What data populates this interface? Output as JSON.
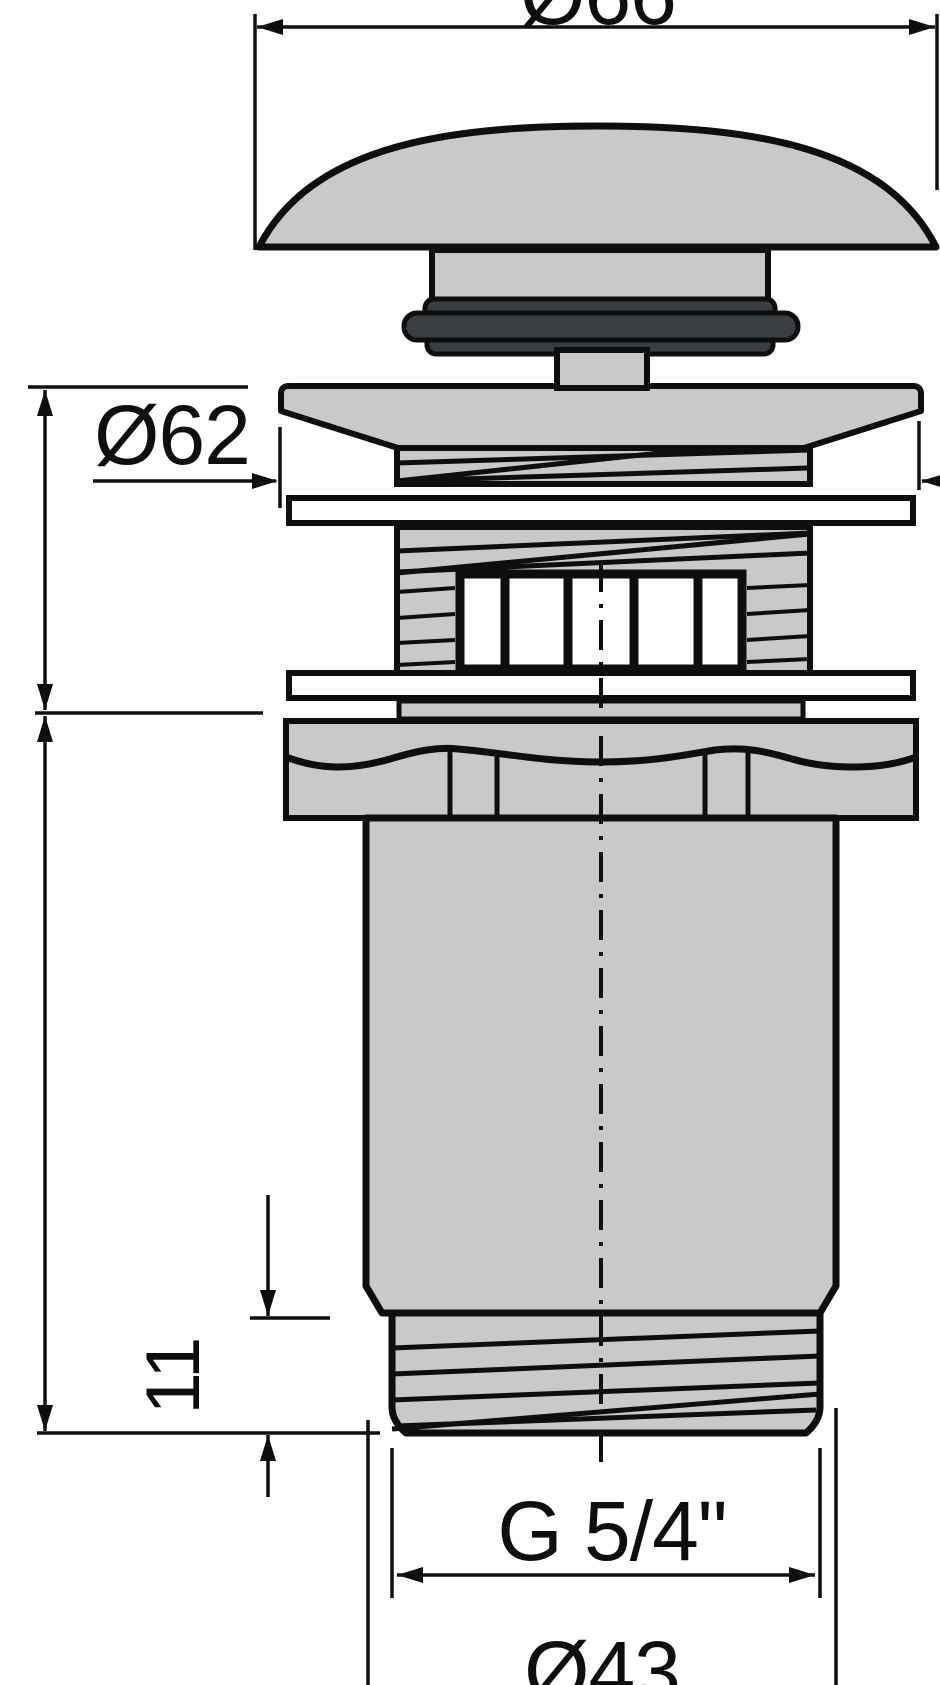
{
  "drawing": {
    "type": "technical-dimension-drawing",
    "subject": "click-clack basin waste valve, side section view",
    "labels": {
      "cap_diameter": "Ø66",
      "flange_diameter": "Ø62",
      "clamp_range": "max 30",
      "body_length": "69",
      "thread_length": "11",
      "thread_spec": "G 5/4\"",
      "thread_diameter": "Ø43"
    },
    "colors": {
      "background": "#ffffff",
      "part_fill": "#c7c9cb",
      "seal_fill": "#3a3e41",
      "line": "#0d0e0f",
      "washer_fill": "#ffffff"
    }
  }
}
